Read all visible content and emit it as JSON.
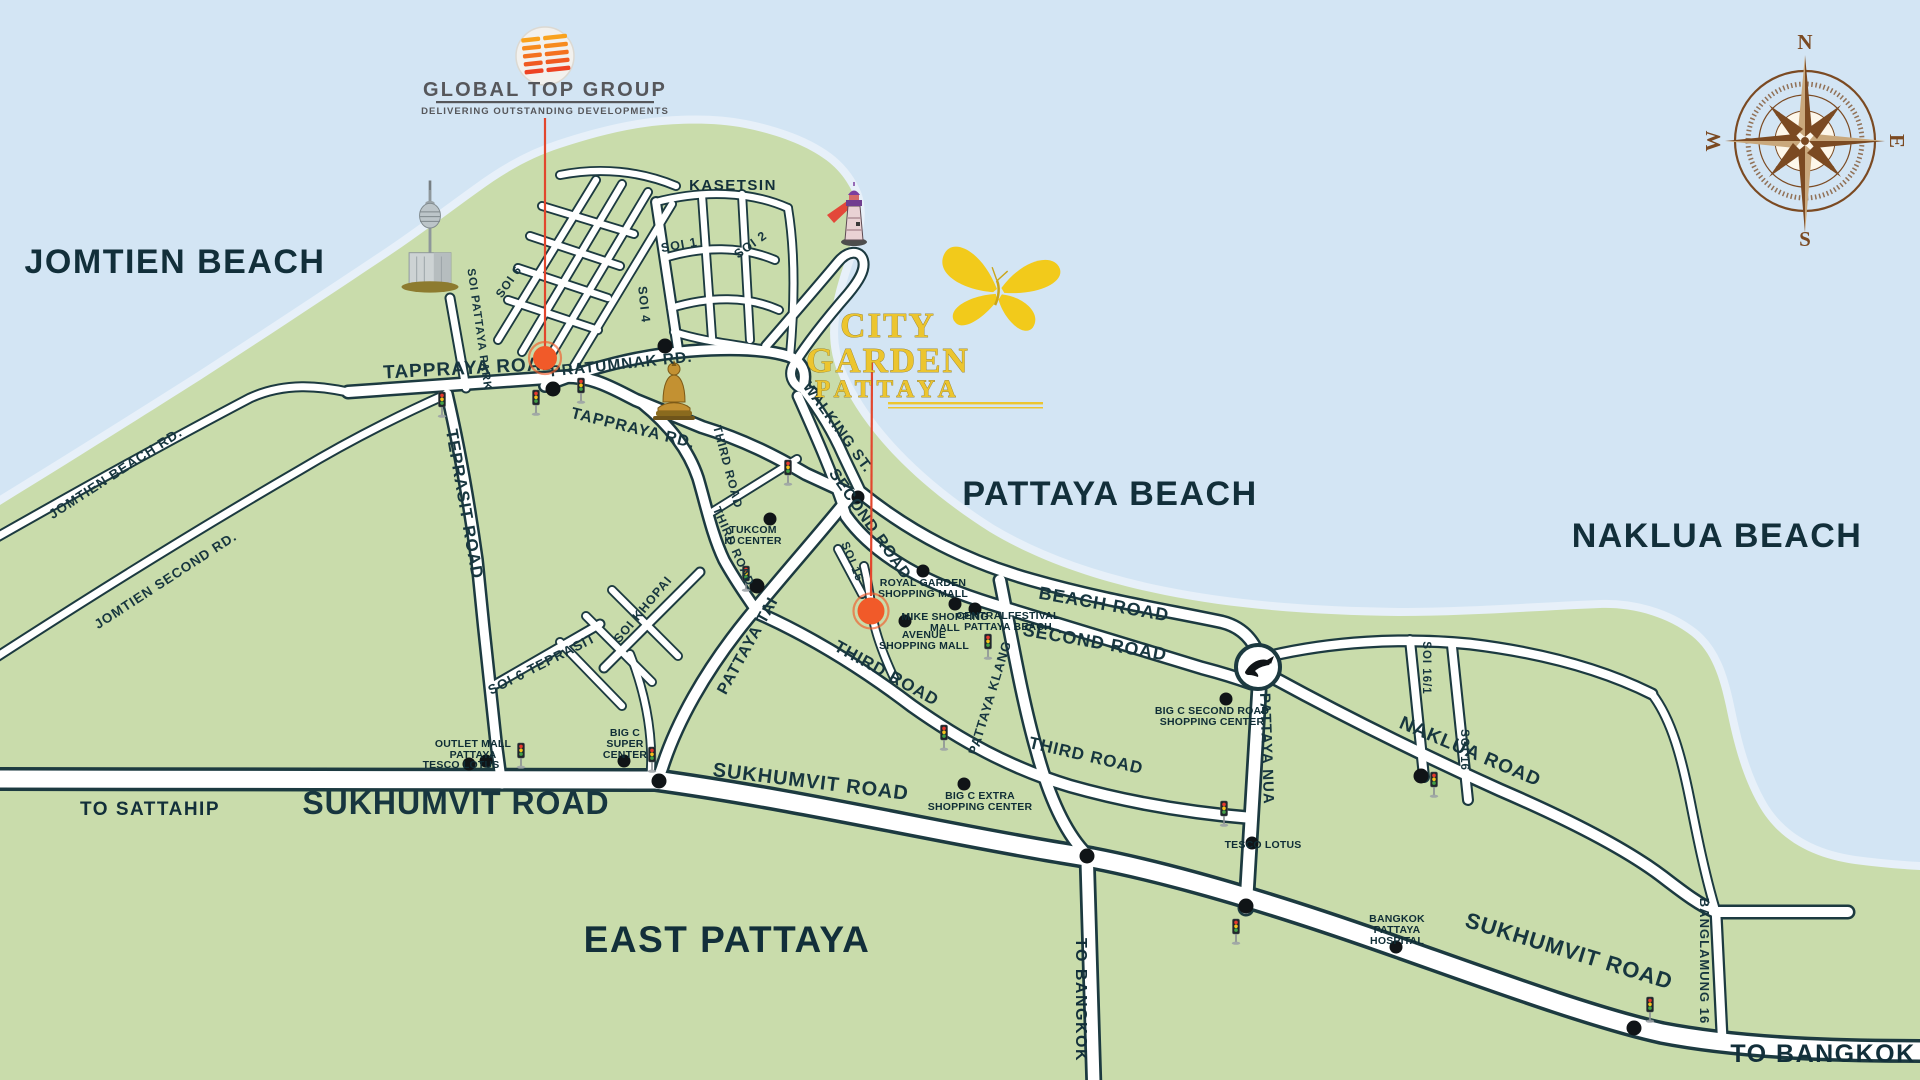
{
  "branding": {
    "global_top_group": {
      "name": "GLOBAL TOP GROUP",
      "tagline": "DELIVERING OUTSTANDING DEVELOPMENTS"
    },
    "city_garden": {
      "line1": "CITY",
      "line2": "GARDEN",
      "line3": "PATTAYA"
    }
  },
  "compass": {
    "north": "N",
    "east": "E",
    "south": "S",
    "west": "W"
  },
  "areas": {
    "jomtien_beach": "JOMTIEN BEACH",
    "pattaya_beach": "PATTAYA BEACH",
    "naklua_beach": "NAKLUA BEACH",
    "east_pattaya": "EAST PATTAYA",
    "kasetsin": "KASETSIN",
    "to_sattahip": "TO SATTAHIP",
    "to_bangkok_vertical": "TO BANGKOK",
    "to_bangkok_corner": "TO BANGKOK"
  },
  "roads": {
    "sukhumvit_big": "SUKHUMVIT ROAD",
    "sukhumvit_mid": "SUKHUMVIT ROAD",
    "sukhumvit_east": "SUKHUMVIT ROAD",
    "tappraya_road": "TAPPRAYA ROAD",
    "tappraya_rd": "TAPPRAYA RD.",
    "pratumnak_rd": "PRATUMNAK RD.",
    "teprasit_road": "TEPRASIT ROAD",
    "soi_6_teprasit": "SOI 6 TEPRASIT",
    "jomtien_beach_rd": "JOMTIEN BEACH RD.",
    "jomtien_second_rd": "JOMTIEN SECOND RD.",
    "soi_pattaya_park": "SOI PATTAYA PARK",
    "soi_khopai": "SOI KHOPAI",
    "soi_1": "SOI 1",
    "soi_2": "SOI 2",
    "soi_4": "SOI 4",
    "soi_6": "SOI 6",
    "soi_15": "SOI 15",
    "soi_16_1": "SOI 16/1",
    "soi_16": "SOI 16",
    "walking_st": "WALKING ST.",
    "second_road_upper": "SECOND ROAD",
    "second_road": "SECOND ROAD",
    "beach_road": "BEACH ROAD",
    "third_road_upper1": "THIRD ROAD",
    "third_road_upper2": "THIRD ROAD",
    "third_road_mid": "THIRD ROAD",
    "third_road_east": "THIRD ROAD",
    "pattaya_tai": "PATTAYA TAI",
    "pattaya_klang": "PATTAYA KLANG",
    "pattaya_nua": "PATTAYA NUA",
    "naklua_road": "NAKLUA ROAD",
    "banglamung_16": "BANGLAMUNG 16"
  },
  "pois": {
    "tukcom": {
      "lines": [
        "TUKCOM",
        "IT CENTER"
      ]
    },
    "royal_garden": {
      "lines": [
        "ROYAL GARDEN",
        "SHOPPING MALL"
      ]
    },
    "mike": {
      "lines": [
        "MIKE SHOPPING",
        "MALL"
      ]
    },
    "central_festival": {
      "lines": [
        "CENTRALFESTIVAL",
        "PATTAYA BEACH"
      ]
    },
    "avenue": {
      "lines": [
        "AVENUE",
        "SHOPPING MALL"
      ]
    },
    "big_c_second": {
      "lines": [
        "BIG C SECOND ROAD",
        "SHOPPING CENTER"
      ]
    },
    "big_c_extra": {
      "lines": [
        "BIG C EXTRA",
        "SHOPPING CENTER"
      ]
    },
    "big_c_super": {
      "lines": [
        "BIG C",
        "SUPER",
        "CENTER"
      ]
    },
    "tesco_central": {
      "lines": [
        "TESCO LOTUS"
      ]
    },
    "tesco_south": {
      "lines": [
        "TESCO LOTUS"
      ]
    },
    "outlet_mall": {
      "lines": [
        "OUTLET MALL",
        "PATTAYA"
      ]
    },
    "bangkok_hospital": {
      "lines": [
        "BANGKOK",
        "PATTAYA",
        "HOSPITAL"
      ]
    }
  },
  "colors": {
    "sea": "#d3e5f4",
    "land": "#c9dcab",
    "beach_band": "#e7f0f9",
    "road_outline": "#1c3a40",
    "road_fill": "#ffffff",
    "label": "#17363f",
    "marker_orange": "#f15a29",
    "leader_red": "#e2462d",
    "logo_gold": "#ecc52f",
    "logo_gray": "#56575b",
    "compass_brown": "#7b4a22"
  }
}
